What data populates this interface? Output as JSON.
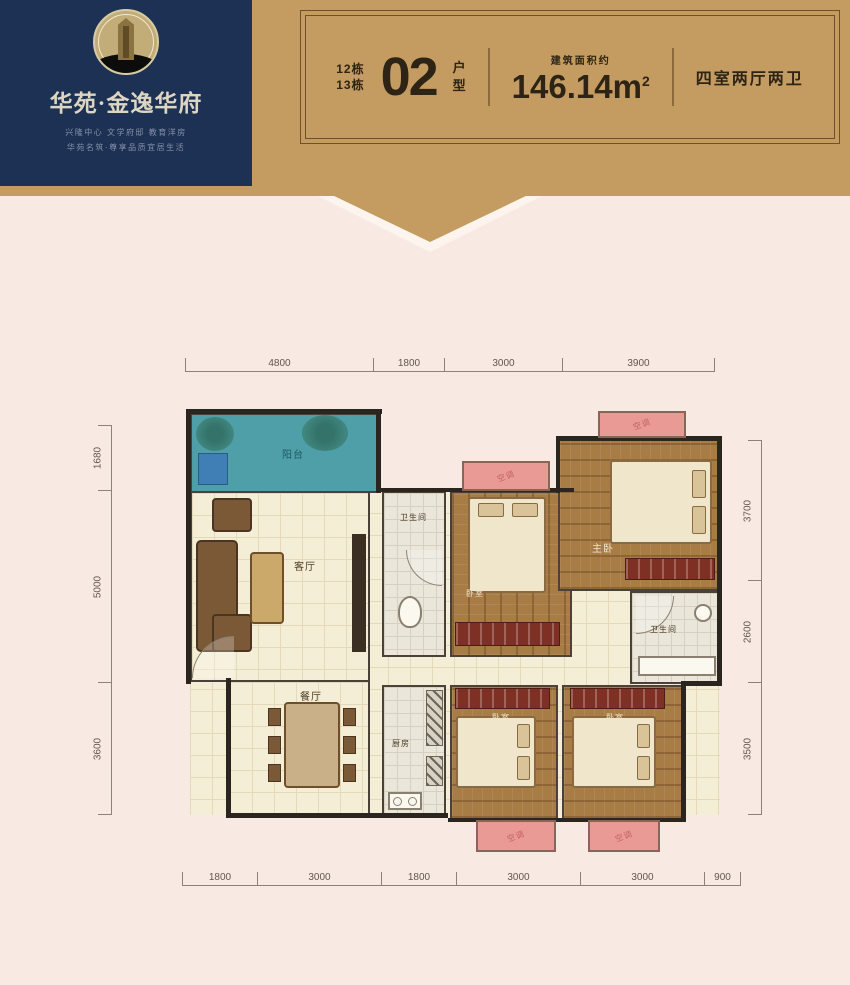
{
  "brand": {
    "name": "华苑·金逸华府",
    "tagline1": "兴隆中心 文学府邸 教育洋房",
    "tagline2": "华苑名筑·尊享品质宜居生活"
  },
  "banner": {
    "building_1": "12栋",
    "building_2": "13栋",
    "unit_number": "02",
    "unit_suffix_1": "户",
    "unit_suffix_2": "型",
    "area_label": "建筑面积约",
    "area_value": "146.14m",
    "area_sup": "2",
    "layout_text": "四室两厅两卫"
  },
  "floorplan": {
    "rooms": {
      "balcony": "阳台",
      "living": "客厅",
      "bath": "卫生间",
      "bedroom": "卧室",
      "master": "主卧",
      "dining": "餐厅",
      "kitchen": "厨房",
      "ac": "空调"
    },
    "dimensions": {
      "top": [
        "4800",
        "1800",
        "3000",
        "3900"
      ],
      "bottom": [
        "1800",
        "3000",
        "1800",
        "3000",
        "3000",
        "900"
      ],
      "left": [
        "1680",
        "5000",
        "3600"
      ],
      "right": [
        "3700",
        "2600",
        "3500"
      ]
    }
  },
  "colors": {
    "navy": "#1c3153",
    "tan": "#c49b60",
    "pink_bg": "#f9e9e3",
    "teal_balcony": "#4f9fa8",
    "bay_pink": "#e99a95"
  }
}
